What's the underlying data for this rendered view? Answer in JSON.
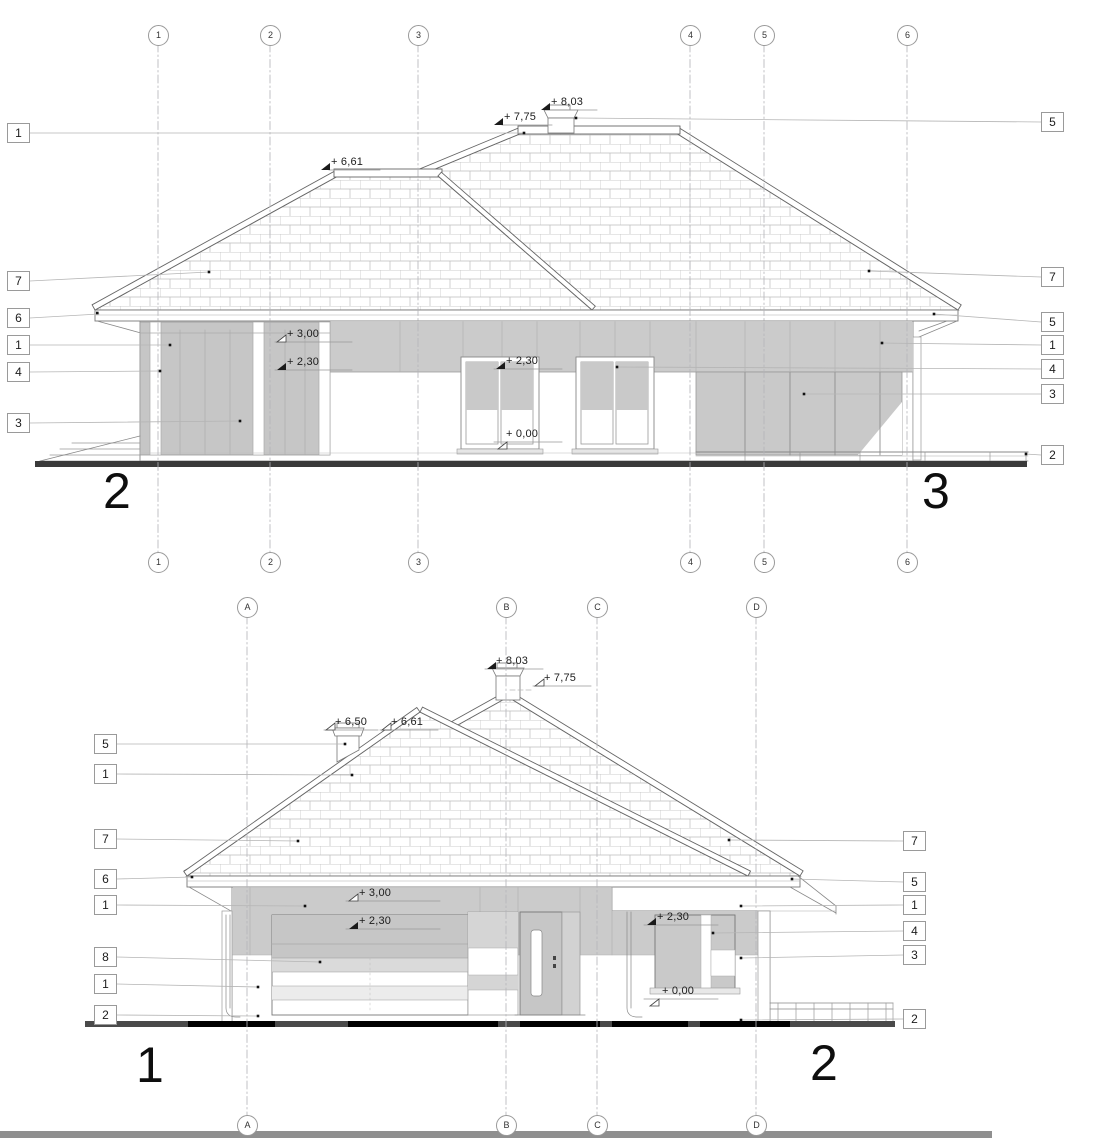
{
  "top_elevation": {
    "label_left": "2",
    "label_right": "3",
    "grid_labels": [
      "1",
      "2",
      "3",
      "4",
      "5",
      "6"
    ],
    "callouts_left": [
      "1",
      "7",
      "6",
      "1",
      "4",
      "3"
    ],
    "callouts_right": [
      "5",
      "7",
      "5",
      "1",
      "4",
      "3",
      "2"
    ],
    "levels": {
      "chimney_top": "+ 8,03",
      "ridge": "+ 7,75",
      "secondary_ridge": "+ 6,61",
      "wall_top": "+ 3,00",
      "lintel_left": "+ 2,30",
      "lintel_mid": "+ 2,30",
      "floor": "+ 0,00"
    }
  },
  "bottom_elevation": {
    "label_left": "1",
    "label_right": "2",
    "grid_labels": [
      "A",
      "B",
      "C",
      "D"
    ],
    "callouts_left": [
      "5",
      "1",
      "7",
      "6",
      "1",
      "8",
      "1",
      "2"
    ],
    "callouts_right": [
      "7",
      "5",
      "1",
      "4",
      "3",
      "2"
    ],
    "levels": {
      "chimney_top": "+ 8,03",
      "ridge": "+ 7,75",
      "small_chimney": "+ 6,50",
      "secondary_ridge": "+ 6,61",
      "wall_top": "+ 3,00",
      "lintel_garage": "+ 2,30",
      "lintel_window": "+ 2,30",
      "floor": "+ 0,00"
    }
  }
}
